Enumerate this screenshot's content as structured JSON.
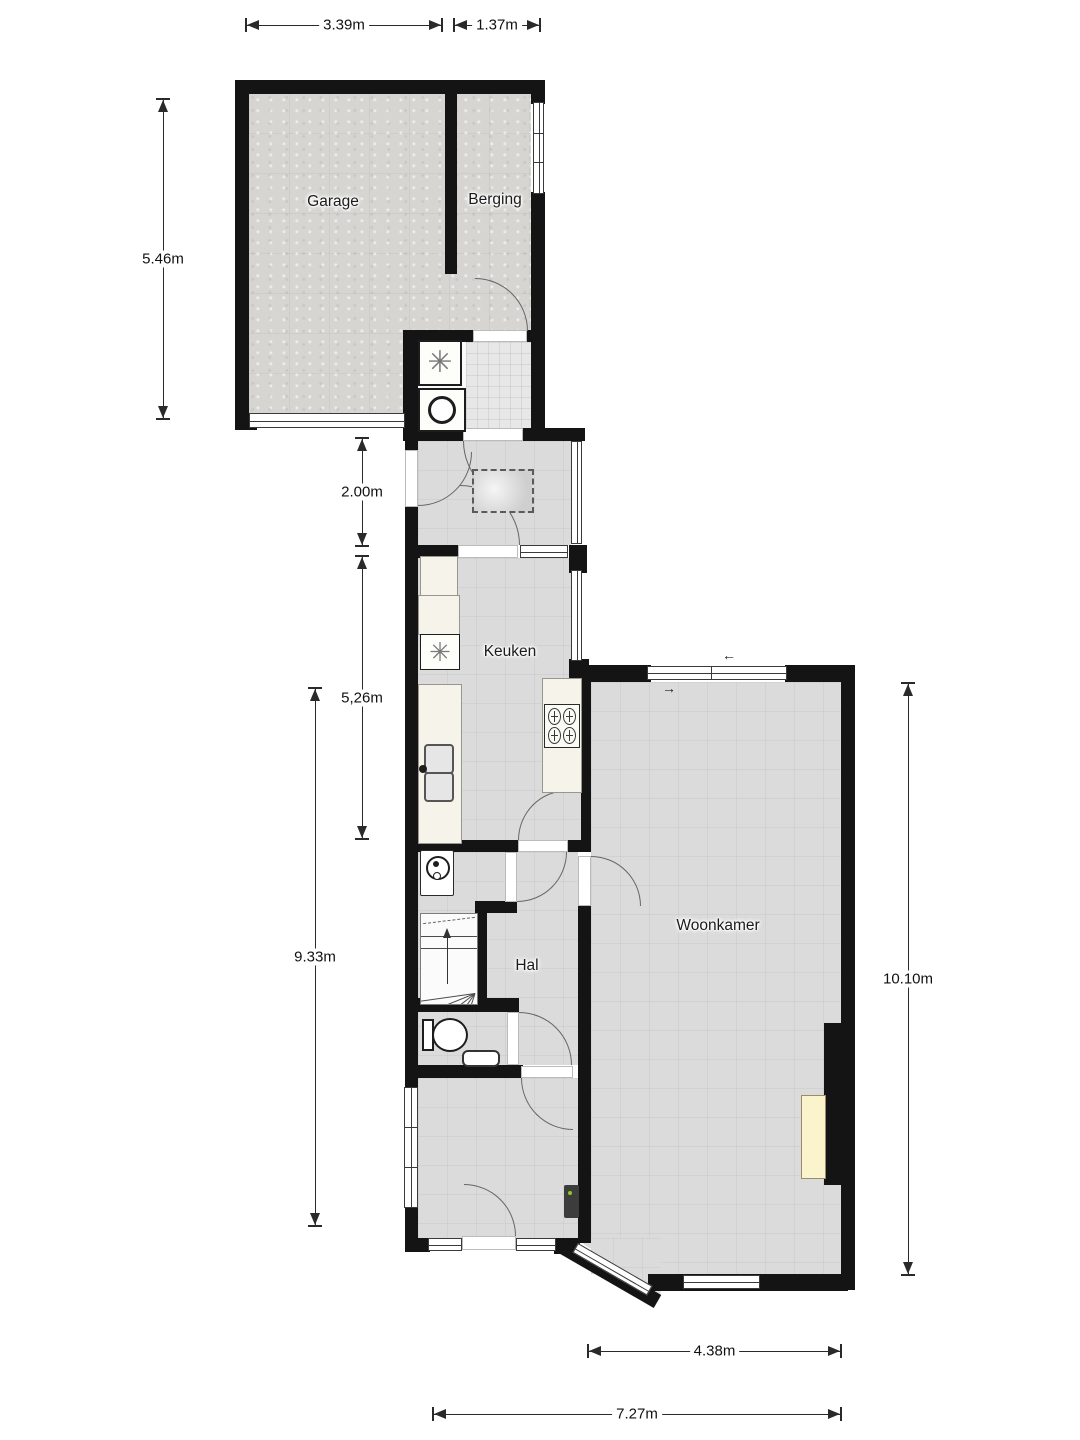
{
  "plan_title": "Begane grond plattegrond",
  "rooms": {
    "garage": {
      "label": "Garage"
    },
    "berging": {
      "label": "Berging"
    },
    "keuken": {
      "label": "Keuken"
    },
    "hal": {
      "label": "Hal"
    },
    "woonkamer": {
      "label": "Woonkamer"
    }
  },
  "dimensions": {
    "garage_width": "3.39m",
    "berging_width": "1.37m",
    "garage_depth": "5.46m",
    "scullery_depth": "2.00m",
    "kitchen_depth": "5,26m",
    "hall_depth": "9.33m",
    "living_depth": "10.10m",
    "living_width": "4.38m",
    "total_width": "7.27m"
  },
  "icons": {
    "washing_machine": "✳",
    "dishwasher": "✳",
    "slide_arrow_left": "←",
    "slide_arrow_right": "→"
  },
  "colors": {
    "wall": "#141414",
    "floor": "#dbdbdb",
    "garage_floor": "#d6d5d1",
    "counter": "#f6f3ea",
    "fireplace": "#fbf3cc",
    "background": "#ffffff"
  }
}
